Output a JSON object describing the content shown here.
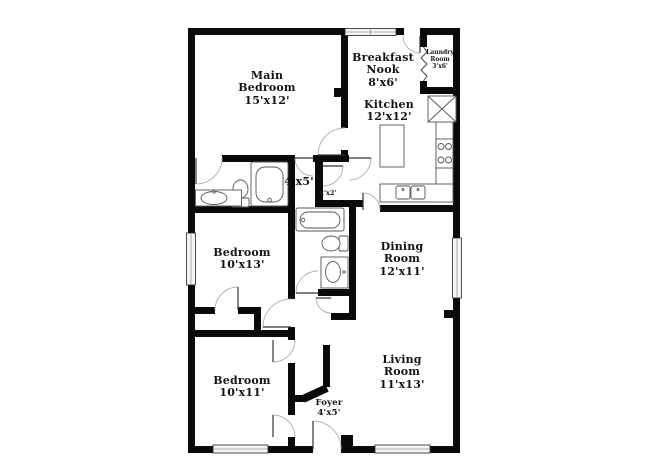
{
  "title": "Floor plan",
  "colors": {
    "wall": "#0a0a0a",
    "fixture_stroke": "#555555",
    "door_arc": "#b5b5b5",
    "window_fill": "#f4f4f4",
    "background": "#ffffff"
  },
  "rooms": {
    "main_bedroom": {
      "name": "Main Bedroom",
      "dims": "15'x12'"
    },
    "breakfast_nook": {
      "name": "Breakfast Nook",
      "dims": "8'x6'"
    },
    "laundry_room": {
      "name": "Laundry Room",
      "dims": "3'x6'"
    },
    "kitchen": {
      "name": "Kitchen",
      "dims": "12'x12'"
    },
    "hall_bath": {
      "dims": "4'x5'"
    },
    "hall_closet": {
      "dims": "2'x2'"
    },
    "bedroom_middle": {
      "name": "Bedroom",
      "dims": "10'x13'"
    },
    "dining_room": {
      "name": "Dining Room",
      "dims": "12'x11'"
    },
    "bedroom_lower": {
      "name": "Bedroom",
      "dims": "10'x11'"
    },
    "living_room": {
      "name": "Living Room",
      "dims": "11'x13'"
    },
    "foyer": {
      "name": "Foyer",
      "dims": "4'x5'"
    }
  }
}
